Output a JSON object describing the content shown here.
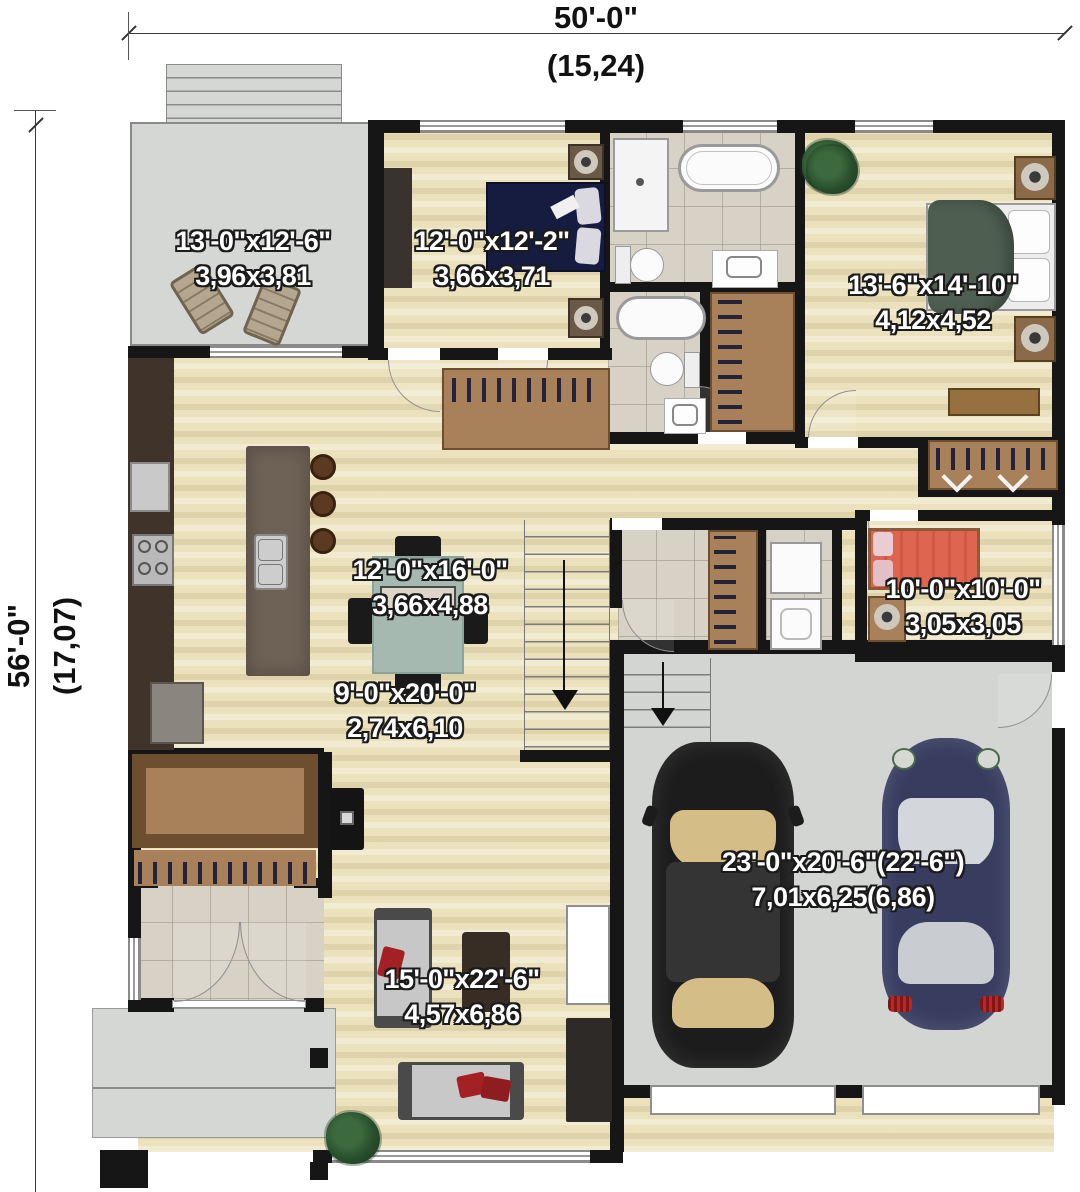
{
  "dimensions": {
    "width_imperial": "50'-0\"",
    "width_metric": "(15,24)",
    "height_imperial": "56'-0\"",
    "height_metric": "(17,07)"
  },
  "rooms": {
    "patio": {
      "imperial": "13'-0\"x12'-6\"",
      "metric": "3,96x3,81"
    },
    "bedroom_2": {
      "imperial": "12'-0\"x12'-2\"",
      "metric": "3,66x3,71"
    },
    "master_bedroom": {
      "imperial": "13'-6\"x14'-10\"",
      "metric": "4,12x4,52"
    },
    "dining": {
      "imperial": "12'-0\"x16'-0\"",
      "metric": "3,66x4,88"
    },
    "kitchen": {
      "imperial": "9'-0\"x20'-0\"",
      "metric": "2,74x6,10"
    },
    "bedroom_3": {
      "imperial": "10'-0\"x10'-0\"",
      "metric": "3,05x3,05"
    },
    "garage": {
      "imperial": "23'-0\"x20'-6\"(22'-6\")",
      "metric": "7,01x6,25(6,86)"
    },
    "living": {
      "imperial": "15'-0\"x22'-6\"",
      "metric": "4,57x6,86"
    }
  },
  "colors": {
    "wall": "#161616",
    "wood_floor": "#ebe2bd",
    "concrete": "#d5d7d4",
    "tile": "#d8d2c6",
    "closet_wood": "#a8805a",
    "label_text": "#ffffff"
  }
}
